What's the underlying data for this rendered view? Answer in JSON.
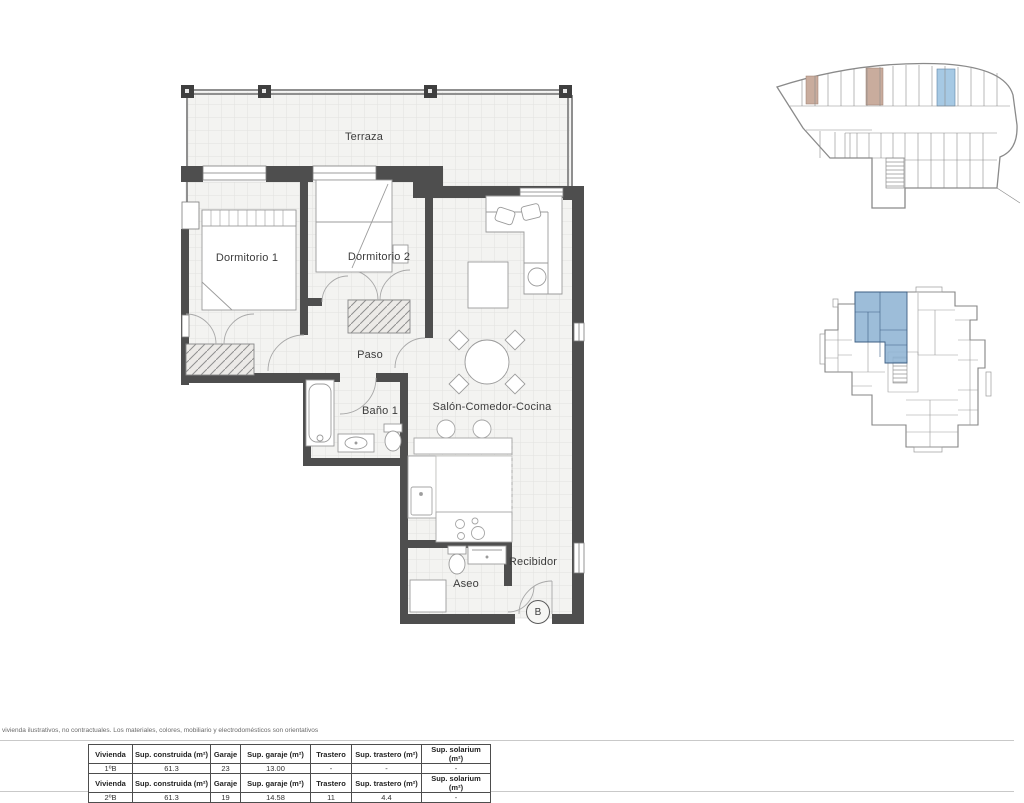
{
  "floor_plan": {
    "rooms": [
      {
        "id": "terraza",
        "label": "Terraza"
      },
      {
        "id": "dormitorio-1",
        "label": "Dormitorio 1"
      },
      {
        "id": "dormitorio-2",
        "label": "Dormitorio 2"
      },
      {
        "id": "paso",
        "label": "Paso"
      },
      {
        "id": "bano-1",
        "label": "Baño 1"
      },
      {
        "id": "salon-comedor-cocina",
        "label": "Salón-Comedor-Cocina"
      },
      {
        "id": "aseo",
        "label": "Aseo"
      },
      {
        "id": "recibidor",
        "label": "Recibidor"
      }
    ],
    "unit_marker": "B"
  },
  "colors": {
    "unit_highlight": "#8fb4d4",
    "unit_highlight_stroke": "#3e5f83",
    "garage_parking_highlight": "#a6c9e4",
    "garage_storage_highlight": "#c9ac9d"
  },
  "footer": {
    "disclaimer": "vivienda ilustrativos, no contractuales. Los materiales, colores, mobiliario y electrodomésticos son orientativos",
    "tables": [
      {
        "headers": [
          "Vivienda",
          "Sup. construida (m²)",
          "Garaje",
          "Sup. garaje (m²)",
          "Trastero",
          "Sup. trastero (m²)",
          "Sup. solarium (m²)"
        ],
        "row": [
          "1ºB",
          "61.3",
          "23",
          "13.00",
          "-",
          "-",
          "-"
        ]
      },
      {
        "headers": [
          "Vivienda",
          "Sup. construida (m²)",
          "Garaje",
          "Sup. garaje (m²)",
          "Trastero",
          "Sup. trastero (m²)",
          "Sup. solarium (m²)"
        ],
        "row": [
          "2ºB",
          "61.3",
          "19",
          "14.58",
          "11",
          "4.4",
          "-"
        ]
      }
    ]
  }
}
